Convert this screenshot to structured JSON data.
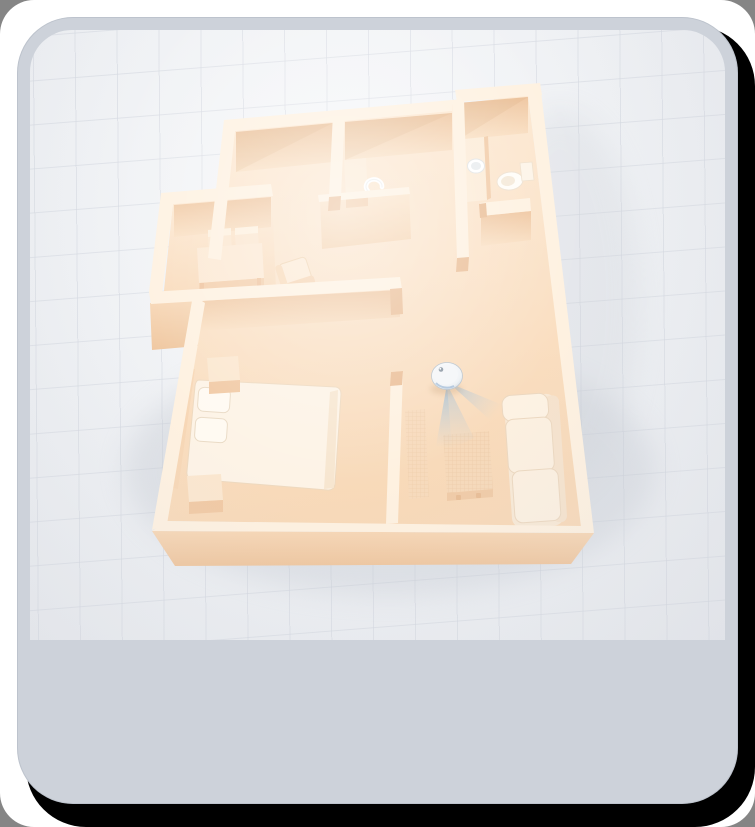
{
  "meta": {
    "kind": "illustration",
    "description": "3D isometric floor plan of a one-bedroom apartment rendered in cream/peach tones; a round smart robot device on the living-room floor projects a blue fan-shaped sensor beam; no visible text anywhere in the image",
    "canvas": {
      "width": 755,
      "height": 827
    }
  },
  "palette": {
    "outer-bg": "#858585",
    "page-white": "#ffffff",
    "page-shadow": "#000000",
    "card-bg": "#cdd2da",
    "scene-bg": "#eff1f4",
    "grid-line": "rgba(201,206,216,0.55)",
    "floor-light": "#fde9d3",
    "floor-dark": "#f8d9b8",
    "wall-top": "#fef1e0",
    "wall-face": "#f4cfab",
    "wall-face-dark": "#efc69e",
    "wall-back-dark": "#eec49d",
    "wall-back-light": "#fae0c3",
    "wall-cap": "#eabd95",
    "wood-top": "#fbe6cd",
    "wood-face": "#f1c9a3",
    "fabric-white": "#fdf3e6",
    "fabric-stroke": "#ecd8c0",
    "robot-body": "#f2f5f7",
    "robot-rim": "#b7c2cc",
    "beam-blue": "#5da8e8"
  },
  "scene": {
    "label": "apartment-floorplan-3d",
    "rooms": [
      {
        "name": "storage-room",
        "position": "top-left"
      },
      {
        "name": "kitchen",
        "position": "top-middle"
      },
      {
        "name": "bathroom",
        "position": "top-right"
      },
      {
        "name": "dining-room",
        "position": "mid-left"
      },
      {
        "name": "bedroom",
        "position": "bottom-left"
      },
      {
        "name": "living-room",
        "position": "bottom-right"
      }
    ],
    "objects": [
      "bed",
      "pillow",
      "headboard",
      "nightstand-north",
      "nightstand-south",
      "dining-table",
      "dining-chair-1",
      "dining-chair-2",
      "hall-armchair",
      "sofa",
      "tv-panel",
      "media-sideboard",
      "bathroom-vanity",
      "sink-basin",
      "toilet",
      "kitchen-counter",
      "faucet"
    ],
    "device": {
      "name": "robot-vacuum",
      "beam": "sensor-beam-cone",
      "beam_color": "#5da8e8"
    }
  }
}
